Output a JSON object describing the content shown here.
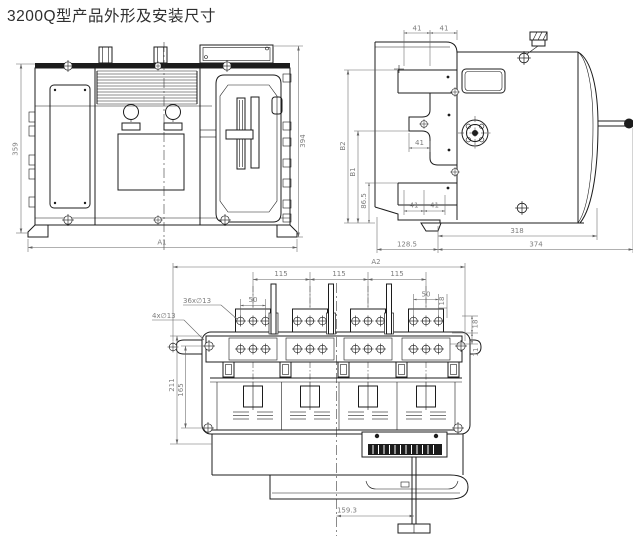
{
  "title": "3200Q型产品外形及安装尺寸",
  "front_view": {
    "height_left": "359",
    "height_right": "394",
    "width_overall": "A1"
  },
  "side_view": {
    "top_pitch_a": "41",
    "top_pitch_b": "41",
    "height_b2": "B2",
    "height_b1": "B1",
    "height_lower": "86.5",
    "mid_pitch": "41",
    "bottom_pitch_a": "41",
    "bottom_pitch_b": "41",
    "depth_body": "318",
    "depth_cover": "128.5",
    "depth_overall": "374"
  },
  "top_view": {
    "width_overall": "A2",
    "pole_pitch_a": "115",
    "pole_pitch_b": "115",
    "pole_pitch_c": "115",
    "terminal_holes": "36x∅13",
    "hole_pitch_left": "50",
    "hole_pitch_right": "50",
    "terminal_edge_offset": "18",
    "mounting_holes": "4x∅13",
    "mount_depth": "211",
    "mount_hole_pitch": "165",
    "edge_offset_a": "18",
    "edge_offset_b": "11",
    "handle_offset": "159.3"
  }
}
